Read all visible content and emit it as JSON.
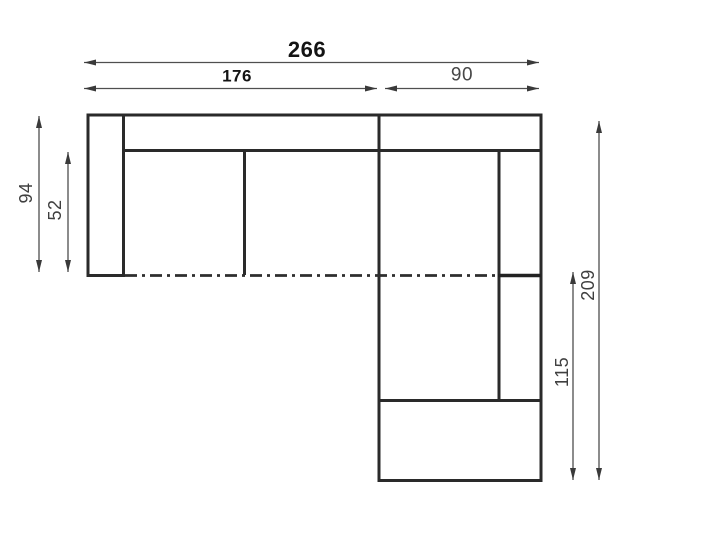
{
  "diagram": {
    "title": "corner-sofa-plan-with-dimensions",
    "background": "#ffffff",
    "colors": {
      "outline": "#2a2a2a",
      "dimension_lines": "#4f4f4f",
      "label_bold": "#141414",
      "label_gray": "#3f3f3f"
    },
    "dimensions": {
      "total_width": "266",
      "left_section_width": "176",
      "right_section_width": "90",
      "total_depth": "94",
      "seat_depth": "52",
      "right_section_length": "209",
      "chaise_length": "115"
    }
  }
}
